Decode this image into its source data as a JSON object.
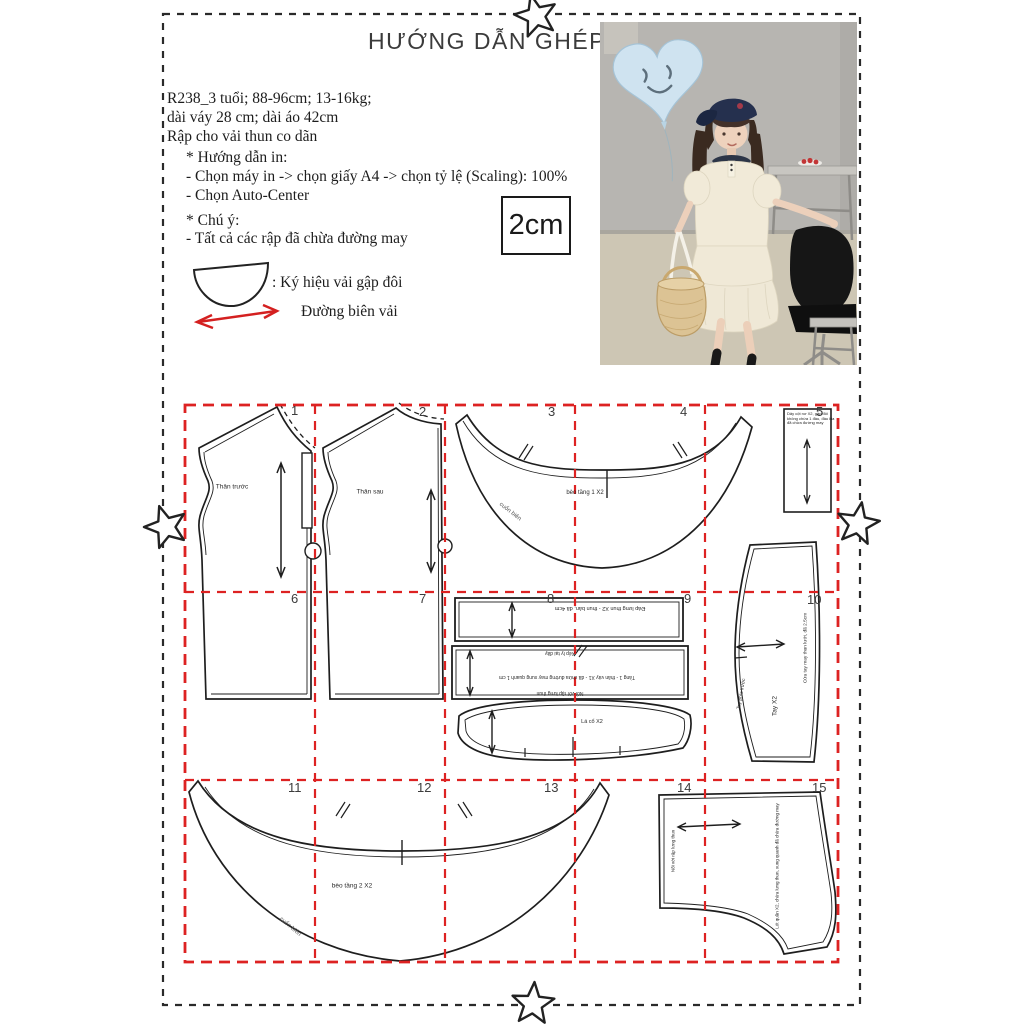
{
  "title": "HƯỚNG DẪN GHÉP RẬP",
  "header": {
    "size_info_line1": "R238_3 tuổi; 88-96cm; 13-16kg;",
    "size_info_line2": "dài váy 28 cm; dài áo 42cm",
    "size_info_line3": "Rập cho vải thun co dãn",
    "print_guide": {
      "heading": "* Hướng dẫn in:",
      "line1": "- Chọn máy in -> chọn giấy A4  -> chọn tỷ lệ (Scaling): 100%",
      "line2": "- Chọn Auto-Center"
    },
    "note": {
      "heading": "* Chú ý:",
      "line1": "- Tất cả các rập đã chừa đường may"
    },
    "scale_box_label": "2cm",
    "legend": {
      "fold_symbol_label": ": Ký hiệu vải gập đôi",
      "selvedge_label": "Đường biên vải"
    }
  },
  "grid": {
    "numbers": [
      "1",
      "2",
      "3",
      "4",
      "5",
      "6",
      "7",
      "8",
      "9",
      "10",
      "11",
      "12",
      "13",
      "14",
      "15"
    ]
  },
  "pieces": {
    "front_bodice_label": "Thân trước",
    "back_bodice_label": "Thân sau",
    "flounce_tier1_label": "bèo tầng 1 X2",
    "flounce1_edge_note": "cuốn biên",
    "tie_strip_line1": "Dây cột nơ X2, gập đôi",
    "tie_strip_line2": "không chừa 1 đầu, đầu kia",
    "tie_strip_line3": "đã chừa đường may",
    "waistband_label": "Đáp lưng thun X2 - thun bản, đã 4cm",
    "skirt_panel_pleat_note": "Xếp ly tại đây",
    "skirt_panel_label": "Tầng 1 - thân váy X1 - đã chừa đường may xung quanh 1 cm",
    "skirt_panel_join_note": "Nối với rập lưng thun",
    "collar_label": "Lá cổ X2",
    "sleeve_label": "Tay X2",
    "sleeve_cuff_note": "Cửa tay may thun lưới, đã 2.5cm",
    "sleeve_front_note": "Tay phía trước",
    "flounce_tier2_label": "bèo tầng 2 X2",
    "flounce2_edge_note": "cuốn biên",
    "shorts_join_note": "Nối với rập lưng thun",
    "shorts_label": "Lót quần X2, chừa lưng thun, xung quanh đã chừa đường may"
  },
  "colors": {
    "grid_red": "#dd2222",
    "ink": "#222222",
    "photo_wall": "#b7b5b1",
    "photo_floor": "#cdc6b4",
    "balloon_blue": "#cfe3f0",
    "outfit_cream": "#f1ead8",
    "cap_navy": "#25304e"
  }
}
